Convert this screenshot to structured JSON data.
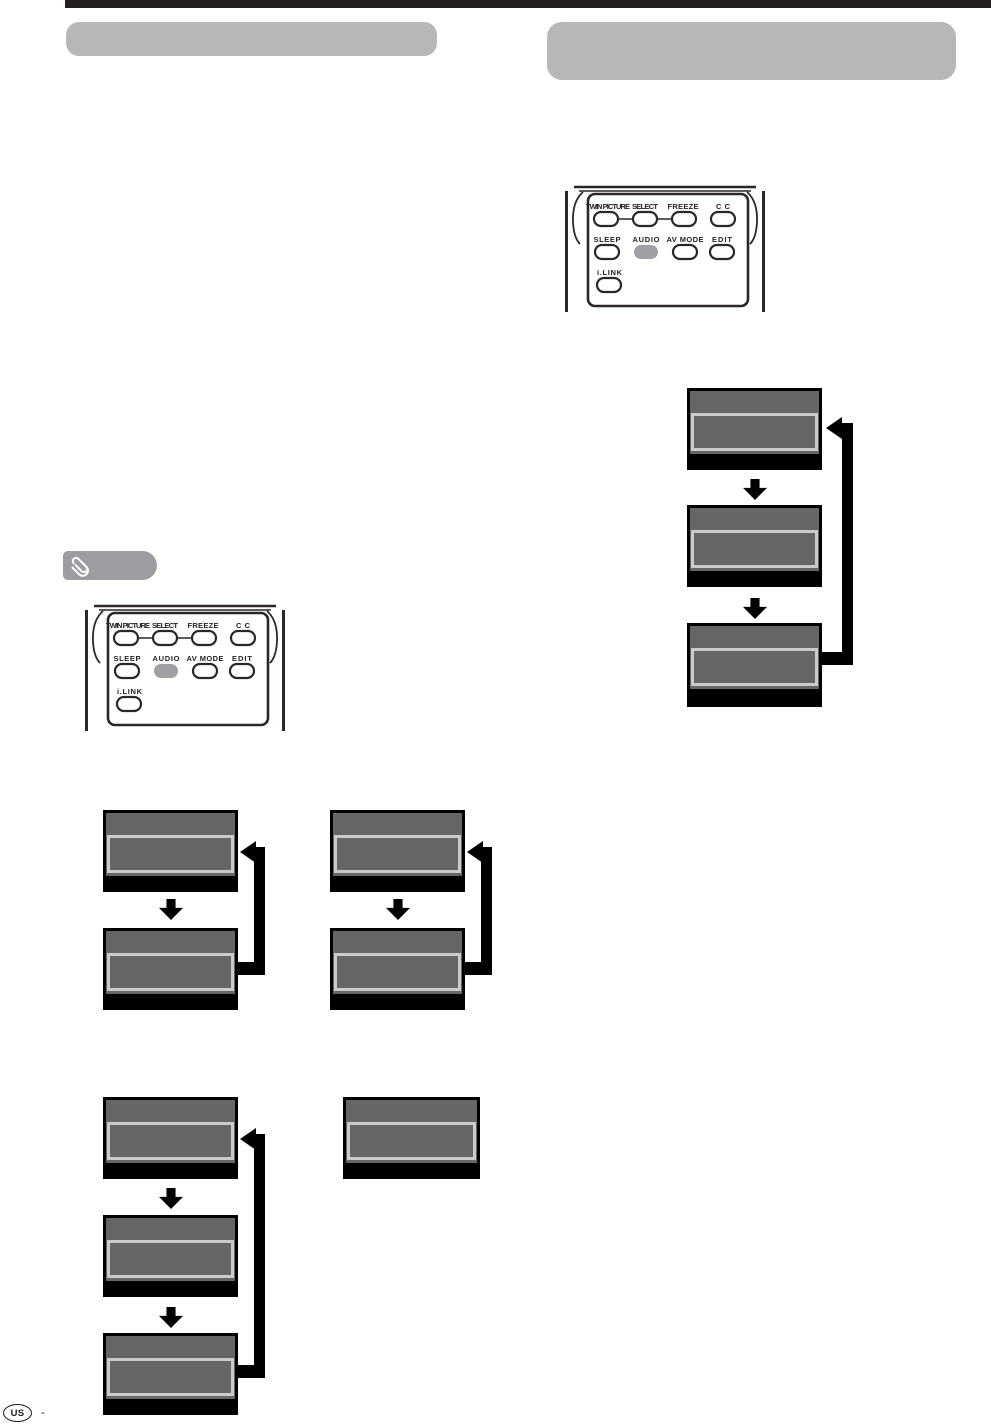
{
  "remote_control": {
    "buttons": {
      "row1": [
        "TWIN PICTURE",
        "SELECT",
        "FREEZE",
        "CC"
      ],
      "row2": [
        "SLEEP",
        "AUDIO",
        "AV MODE",
        "EDIT"
      ],
      "row3": [
        "i.LINK"
      ]
    },
    "highlighted_button": "AUDIO"
  },
  "icons": {
    "note_icon": "paperclip"
  },
  "footer": {
    "region_code": "US",
    "page_separator": "-"
  },
  "colors": {
    "top_rule": "#231f20",
    "title_bar": "#b5b7b9",
    "note_tab": "#9b9da0",
    "screen_fill": "#666668",
    "screen_inner_border": "#c9cbcd",
    "screen_frame": "#000000",
    "arrow": "#000000",
    "remote_line": "#2b2728",
    "remote_button_highlight": "#9ea0a3"
  }
}
